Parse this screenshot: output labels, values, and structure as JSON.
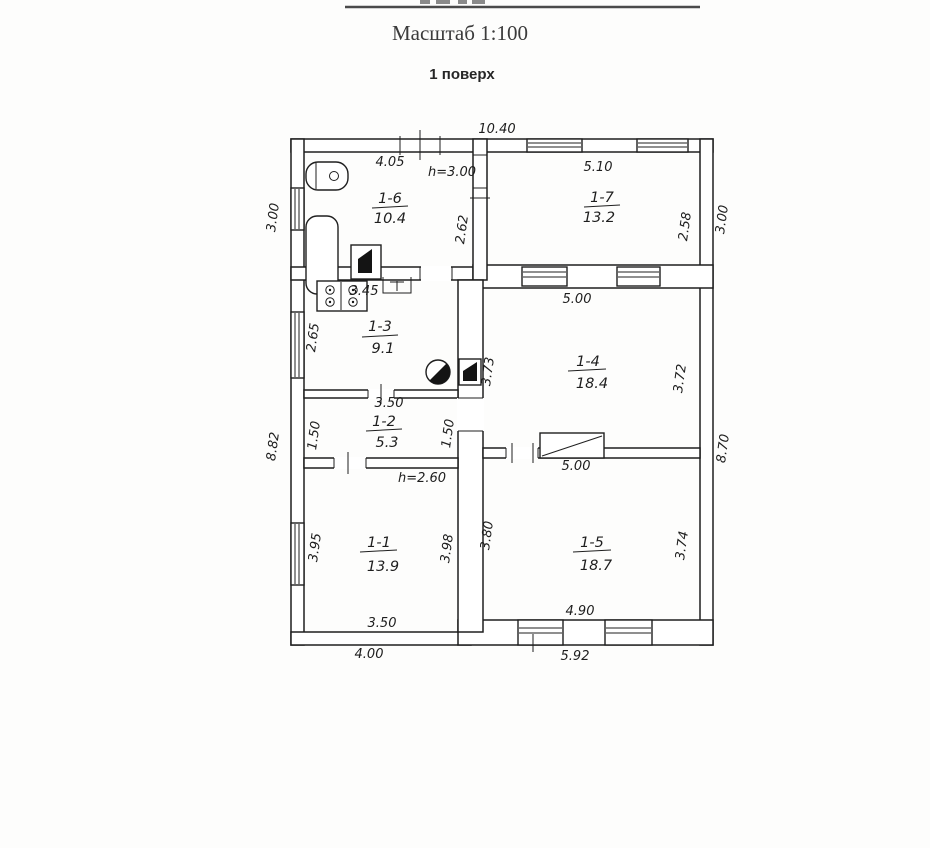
{
  "colors": {
    "ink": "#1f1f1f",
    "paper": "#fdfdfc"
  },
  "header": {
    "scale": "Масштаб 1:100",
    "floor": "1 поверх"
  },
  "rooms": {
    "r11": {
      "id": "1-1",
      "area": "13.9"
    },
    "r12": {
      "id": "1-2",
      "area": "5.3"
    },
    "r13": {
      "id": "1-3",
      "area": "9.1"
    },
    "r14": {
      "id": "1-4",
      "area": "18.4"
    },
    "r15": {
      "id": "1-5",
      "area": "18.7"
    },
    "r16": {
      "id": "1-6",
      "area": "10.4"
    },
    "r17": {
      "id": "1-7",
      "area": "13.2"
    }
  },
  "dims": {
    "overall_top": "10.40",
    "left_top": "3.00",
    "left_bottom": "8.82",
    "right_top": "3.00",
    "right_bottom": "8.70",
    "bottom_left": "4.00",
    "bottom_right": "5.92",
    "r16_top": "4.05",
    "r16_right": "2.62",
    "r17_top": "5.10",
    "r17_right": "2.58",
    "r13_top": "3.45",
    "r13_left": "2.65",
    "r12_top": "3.50",
    "r12_left": "1.50",
    "r12_right": "1.50",
    "r14_top": "5.00",
    "r14_left": "3.73",
    "r14_right": "3.72",
    "r11_left": "3.95",
    "r11_right": "3.98",
    "r11_bottom": "3.50",
    "r15_top": "5.00",
    "r15_left": "3.80",
    "r15_right": "3.74",
    "r15_bottom": "4.90"
  },
  "notes": {
    "height_top": "h=3.00",
    "height_bottom": "h=2.60"
  }
}
